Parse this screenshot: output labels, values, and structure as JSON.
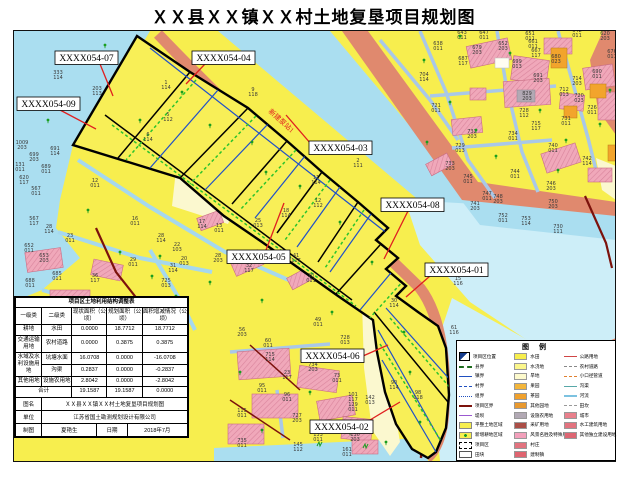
{
  "title": "ＸＸ县ＸＸ镇ＸＸ村土地复垦项目规划图",
  "colors": {
    "farmland": "#f7ee4e",
    "water": "#aadef0",
    "water_light": "#cdeef8",
    "dike_road": "#e0896e",
    "village": "#f0a8ba",
    "village_hatch": "#d9849c",
    "main_road": "#7c120c",
    "secondary_road": "#a9c8e8",
    "channel_line": "#2050c8",
    "new_field_tick": "#2cc32c",
    "project_outline": "#000000",
    "leader": "#e02020",
    "dry_land": "#fbf8cf",
    "orchard": "#f2a42c",
    "tree": "#1a9e1f"
  },
  "map": {
    "river_note": "新建泵站1",
    "callouts": [
      {
        "label": "XXXX054-07",
        "box": [
          55,
          51
        ],
        "leader": [
          100,
          64,
          113,
          96
        ]
      },
      {
        "label": "XXXX054-04",
        "box": [
          192,
          51
        ],
        "leader": [
          205,
          64,
          186,
          84
        ]
      },
      {
        "label": "XXXX054-09",
        "box": [
          17,
          97
        ],
        "leader": [
          60,
          110,
          96,
          129
        ]
      },
      {
        "label": "XXXX054-03",
        "box": [
          309,
          141
        ],
        "leader": [
          311,
          144,
          286,
          115
        ]
      },
      {
        "label": "XXXX054-08",
        "box": [
          381,
          198
        ],
        "leader": [
          408,
          211,
          384,
          259
        ]
      },
      {
        "label": "XXXX054-05",
        "box": [
          227,
          250
        ],
        "leader": [
          266,
          250,
          284,
          203
        ]
      },
      {
        "label": "XXXX054-01",
        "box": [
          425,
          263
        ],
        "leader": [
          430,
          276,
          406,
          297
        ]
      },
      {
        "label": "XXXX054-06",
        "box": [
          301,
          349
        ],
        "leader": [
          363,
          356,
          388,
          345
        ]
      },
      {
        "label": "XXXX054-02",
        "box": [
          310,
          420
        ],
        "leader": [
          370,
          420,
          400,
          402
        ]
      }
    ],
    "parcel_labels": [
      [
        58,
        74,
        "333",
        "114"
      ],
      [
        97,
        90,
        "203",
        "113"
      ],
      [
        22,
        144,
        "1009",
        "203"
      ],
      [
        55,
        150,
        "691",
        "114"
      ],
      [
        34,
        156,
        "699",
        "203"
      ],
      [
        20,
        166,
        "131",
        "011"
      ],
      [
        46,
        168,
        "689",
        "011"
      ],
      [
        24,
        179,
        "620",
        "117"
      ],
      [
        36,
        190,
        "567",
        "011"
      ],
      [
        95,
        182,
        "12",
        "011"
      ],
      [
        135,
        220,
        "16",
        "011"
      ],
      [
        34,
        220,
        "567",
        "117"
      ],
      [
        49,
        228,
        "28",
        "114"
      ],
      [
        70,
        237,
        "23",
        "011"
      ],
      [
        29,
        247,
        "652",
        "011"
      ],
      [
        44,
        257,
        "653",
        "203"
      ],
      [
        30,
        282,
        "688",
        "011"
      ],
      [
        57,
        275,
        "685",
        "011"
      ],
      [
        95,
        277,
        "36",
        "117"
      ],
      [
        133,
        261,
        "29",
        "011"
      ],
      [
        219,
        227,
        "13",
        "011"
      ],
      [
        202,
        223,
        "17",
        "114"
      ],
      [
        161,
        237,
        "28",
        "114"
      ],
      [
        177,
        246,
        "22",
        "103"
      ],
      [
        184,
        260,
        "20",
        "013"
      ],
      [
        173,
        267,
        "31",
        "114"
      ],
      [
        218,
        257,
        "28",
        "203"
      ],
      [
        166,
        282,
        "725",
        "013"
      ],
      [
        166,
        84,
        "1",
        "114"
      ],
      [
        253,
        91,
        "9",
        "118"
      ],
      [
        168,
        116,
        "5",
        "112"
      ],
      [
        148,
        136,
        "6",
        "114"
      ],
      [
        316,
        179,
        "11",
        "114"
      ],
      [
        358,
        162,
        "2",
        "111"
      ],
      [
        318,
        202,
        "12",
        "112"
      ],
      [
        286,
        212,
        "18",
        "114"
      ],
      [
        258,
        222,
        "25",
        "013"
      ],
      [
        296,
        257,
        "41",
        "117"
      ],
      [
        249,
        267,
        "32",
        "117"
      ],
      [
        311,
        277,
        "20",
        "011"
      ],
      [
        394,
        302,
        "30",
        "114"
      ],
      [
        394,
        384,
        "90",
        "114"
      ],
      [
        418,
        394,
        "98",
        "118"
      ],
      [
        458,
        280,
        "15",
        "116"
      ],
      [
        454,
        329,
        "61",
        "116"
      ],
      [
        438,
        45,
        "638",
        "011"
      ],
      [
        462,
        34,
        "643",
        "011"
      ],
      [
        484,
        34,
        "647",
        "011"
      ],
      [
        530,
        35,
        "651",
        "011"
      ],
      [
        533,
        43,
        "661",
        "011"
      ],
      [
        536,
        52,
        "667",
        "117"
      ],
      [
        477,
        49,
        "679",
        "203"
      ],
      [
        503,
        45,
        "652",
        "203"
      ],
      [
        517,
        63,
        "699",
        "013"
      ],
      [
        538,
        77,
        "691",
        "203"
      ],
      [
        424,
        76,
        "704",
        "114"
      ],
      [
        463,
        60,
        "687",
        "117"
      ],
      [
        436,
        107,
        "721",
        "011"
      ],
      [
        527,
        95,
        "829",
        "203"
      ],
      [
        564,
        91,
        "712",
        "013"
      ],
      [
        579,
        97,
        "720",
        "023"
      ],
      [
        577,
        80,
        "714",
        "203"
      ],
      [
        556,
        58,
        "680",
        "023"
      ],
      [
        597,
        73,
        "690",
        "011"
      ],
      [
        612,
        53,
        "676",
        "011"
      ],
      [
        605,
        35,
        "620",
        "203"
      ],
      [
        577,
        32,
        "642",
        "011"
      ],
      [
        592,
        109,
        "726",
        "011"
      ],
      [
        566,
        120,
        "731",
        "011"
      ],
      [
        524,
        112,
        "728",
        "112"
      ],
      [
        536,
        125,
        "715",
        "117"
      ],
      [
        513,
        135,
        "734",
        "011"
      ],
      [
        472,
        133,
        "732",
        "203"
      ],
      [
        460,
        147,
        "729",
        "013"
      ],
      [
        450,
        165,
        "733",
        "203"
      ],
      [
        553,
        147,
        "740",
        "011"
      ],
      [
        587,
        160,
        "742",
        "114"
      ],
      [
        515,
        173,
        "744",
        "011"
      ],
      [
        468,
        178,
        "745",
        "011"
      ],
      [
        487,
        195,
        "747",
        "011"
      ],
      [
        498,
        198,
        "748",
        "203"
      ],
      [
        551,
        185,
        "746",
        "203"
      ],
      [
        475,
        205,
        "741",
        "203"
      ],
      [
        553,
        203,
        "750",
        "203"
      ],
      [
        503,
        217,
        "752",
        "011"
      ],
      [
        526,
        220,
        "753",
        "114"
      ],
      [
        558,
        228,
        "730",
        "111"
      ],
      [
        242,
        331,
        "56",
        "203"
      ],
      [
        318,
        321,
        "49",
        "011"
      ],
      [
        268,
        342,
        "60",
        "011"
      ],
      [
        345,
        339,
        "728",
        "013"
      ],
      [
        270,
        356,
        "715",
        "114"
      ],
      [
        313,
        366,
        "734",
        "203"
      ],
      [
        337,
        377,
        "73",
        "011"
      ],
      [
        287,
        374,
        "23",
        "117"
      ],
      [
        262,
        387,
        "95",
        "011"
      ],
      [
        287,
        396,
        "96",
        "011"
      ],
      [
        353,
        396,
        "101",
        "117"
      ],
      [
        353,
        406,
        "129",
        "011"
      ],
      [
        370,
        399,
        "142",
        "013"
      ],
      [
        242,
        412,
        "115",
        "011"
      ],
      [
        297,
        417,
        "727",
        "203"
      ],
      [
        318,
        436,
        "133",
        "011"
      ],
      [
        355,
        436,
        "130",
        "203"
      ],
      [
        242,
        442,
        "735",
        "011"
      ],
      [
        298,
        446,
        "145",
        "112"
      ],
      [
        347,
        451,
        "161",
        "011"
      ]
    ],
    "trees": [
      [
        105,
        45
      ],
      [
        140,
        120
      ],
      [
        210,
        125
      ],
      [
        252,
        142
      ],
      [
        300,
        186
      ],
      [
        340,
        222
      ],
      [
        48,
        120
      ],
      [
        88,
        210
      ],
      [
        120,
        252
      ],
      [
        152,
        276
      ],
      [
        176,
        296
      ],
      [
        210,
        282
      ],
      [
        262,
        300
      ],
      [
        332,
        312
      ],
      [
        424,
        60
      ],
      [
        450,
        102
      ],
      [
        476,
        130
      ],
      [
        510,
        53
      ],
      [
        540,
        110
      ],
      [
        566,
        140
      ],
      [
        600,
        124
      ],
      [
        427,
        142
      ],
      [
        496,
        156
      ],
      [
        558,
        170
      ],
      [
        610,
        90
      ],
      [
        460,
        36
      ],
      [
        230,
        60
      ],
      [
        182,
        92
      ],
      [
        266,
        172
      ],
      [
        372,
        262
      ],
      [
        404,
        332
      ],
      [
        410,
        372
      ],
      [
        420,
        422
      ],
      [
        240,
        372
      ],
      [
        262,
        430
      ],
      [
        310,
        392
      ],
      [
        350,
        432
      ],
      [
        386,
        442
      ],
      [
        70,
        300
      ],
      [
        160,
        256
      ]
    ]
  },
  "table": {
    "title": "项目区土地利用结构调整表",
    "headers": [
      "一级类",
      "二级类",
      "现状面积（公顷）",
      "规划面积（公顷）",
      "面积增减情况（公顷）"
    ],
    "rows": [
      {
        "l1": "耕地",
        "l2": "水田",
        "now": "0.0000",
        "plan": "18.7712",
        "delta": "18.7712"
      },
      {
        "l1": "交通运输用地",
        "l2": "农村道路",
        "now": "0.0000",
        "plan": "0.3875",
        "delta": "0.3875"
      },
      {
        "l1": "水域及水利设施用地",
        "l2": "坑塘水面",
        "now": "16.0708",
        "plan": "0.0000",
        "delta": "-16.0708"
      },
      {
        "l1": "",
        "l2": "沟渠",
        "now": "0.2837",
        "plan": "0.0000",
        "delta": "-0.2837"
      },
      {
        "l1": "其他用地",
        "l2": "设施农用地",
        "now": "2.8042",
        "plan": "0.0000",
        "delta": "-2.8042"
      }
    ],
    "total": {
      "label": "合计",
      "now": "19.1587",
      "plan": "19.1587",
      "delta": "0.0000"
    },
    "meta": {
      "name_label": "图名",
      "name": "ＸＸ县ＸＸ镇ＸＸ村土地复垦项目规划图",
      "unit_label": "单位",
      "unit": "江苏省国土勘测规划设计有限公司",
      "author_label": "制图",
      "author": "夏艳生",
      "date_label": "日期",
      "date": "2018年7月"
    }
  },
  "legend": {
    "title": "图 例",
    "col1": [
      {
        "sym": "projloc",
        "label": "项目区位置"
      },
      {
        "sym": "dash-green",
        "label": "县界"
      },
      {
        "sym": "line-blue",
        "label": "镇界"
      },
      {
        "sym": "dash-blue",
        "label": "村界"
      },
      {
        "sym": "dashdot-blue",
        "label": "组界"
      },
      {
        "sym": "line-darkred",
        "label": "项目区界"
      },
      {
        "sym": "line-purple",
        "label": "堤坝"
      },
      {
        "sym": "fill-yellow",
        "label": "平整土地区域"
      },
      {
        "sym": "fill-yellow-dot",
        "label": "新增耕地区域"
      },
      {
        "sym": "dashrect",
        "label": "项目区"
      },
      {
        "sym": "rect-white",
        "label": "田块"
      }
    ],
    "col2": [
      {
        "sym": "sw",
        "c": "#f7ee4e",
        "label": "水田"
      },
      {
        "sym": "sw",
        "c": "#fbf68c",
        "label": "水浇地"
      },
      {
        "sym": "sw",
        "c": "#fdfacd",
        "label": "旱地"
      },
      {
        "sym": "sw",
        "c": "#f3b63c",
        "label": "果园"
      },
      {
        "sym": "sw",
        "c": "#f0a12d",
        "label": "茶园"
      },
      {
        "sym": "sw",
        "c": "#e9992f",
        "label": "其他园地"
      },
      {
        "sym": "sw",
        "c": "#b2a9b4",
        "label": "设施农用地"
      },
      {
        "sym": "sw",
        "c": "#ab4f47",
        "label": "采矿用地"
      },
      {
        "sym": "sw",
        "c": "#f2a0bb",
        "label": "风景名胜及特殊用地"
      },
      {
        "sym": "sw",
        "c": "#e2737f",
        "label": "村庄"
      },
      {
        "sym": "sw",
        "c": "#df6470",
        "label": "建制镇"
      }
    ],
    "col3": [
      {
        "sym": "line-red",
        "label": "公路用地"
      },
      {
        "sym": "dash-gray",
        "label": "农村道路"
      },
      {
        "sym": "dash-orange",
        "label": "小口径管道"
      },
      {
        "sym": "line-teal",
        "label": "沟渠"
      },
      {
        "sym": "line-ltblue",
        "label": "河流"
      },
      {
        "sym": "dashdot-gray",
        "label": "田坎"
      },
      {
        "sym": "sw",
        "c": "#e9808c",
        "label": "城市"
      },
      {
        "sym": "sw",
        "c": "#e2737f",
        "label": "水工建筑用地"
      },
      {
        "sym": "sw",
        "c": "#dd6673",
        "label": "其他独立建设用地"
      }
    ]
  }
}
